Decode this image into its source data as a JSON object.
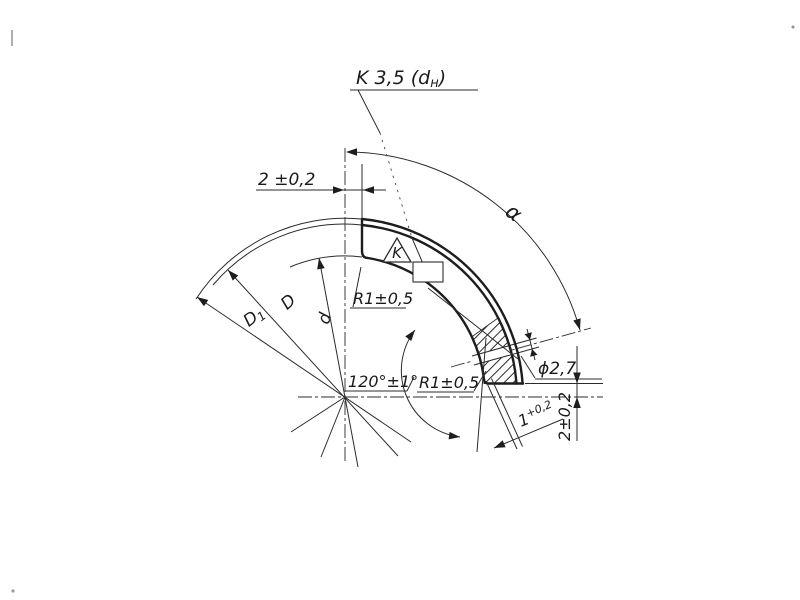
{
  "drawing": {
    "type": "engineering-drawing",
    "background": "#ffffff",
    "ink": "#1d1d1d",
    "labels": {
      "coating": {
        "pre": "K 3,5 (d",
        "sub": "н",
        "post": ")"
      },
      "gap_top": "2 ±0,2",
      "alpha": "α",
      "dia_outer": "D",
      "dia_free": {
        "pre": "D",
        "sub": "1"
      },
      "dia_inner": "d",
      "radius_top": "R1±0,5",
      "angle": "120°±1°",
      "radius_bottom": "R1±0,5",
      "hole_dia": "ϕ2,7",
      "bridge": {
        "main": "1",
        "tol": "+0,2"
      },
      "gap_end": "2±0,2",
      "mark": "K"
    }
  }
}
